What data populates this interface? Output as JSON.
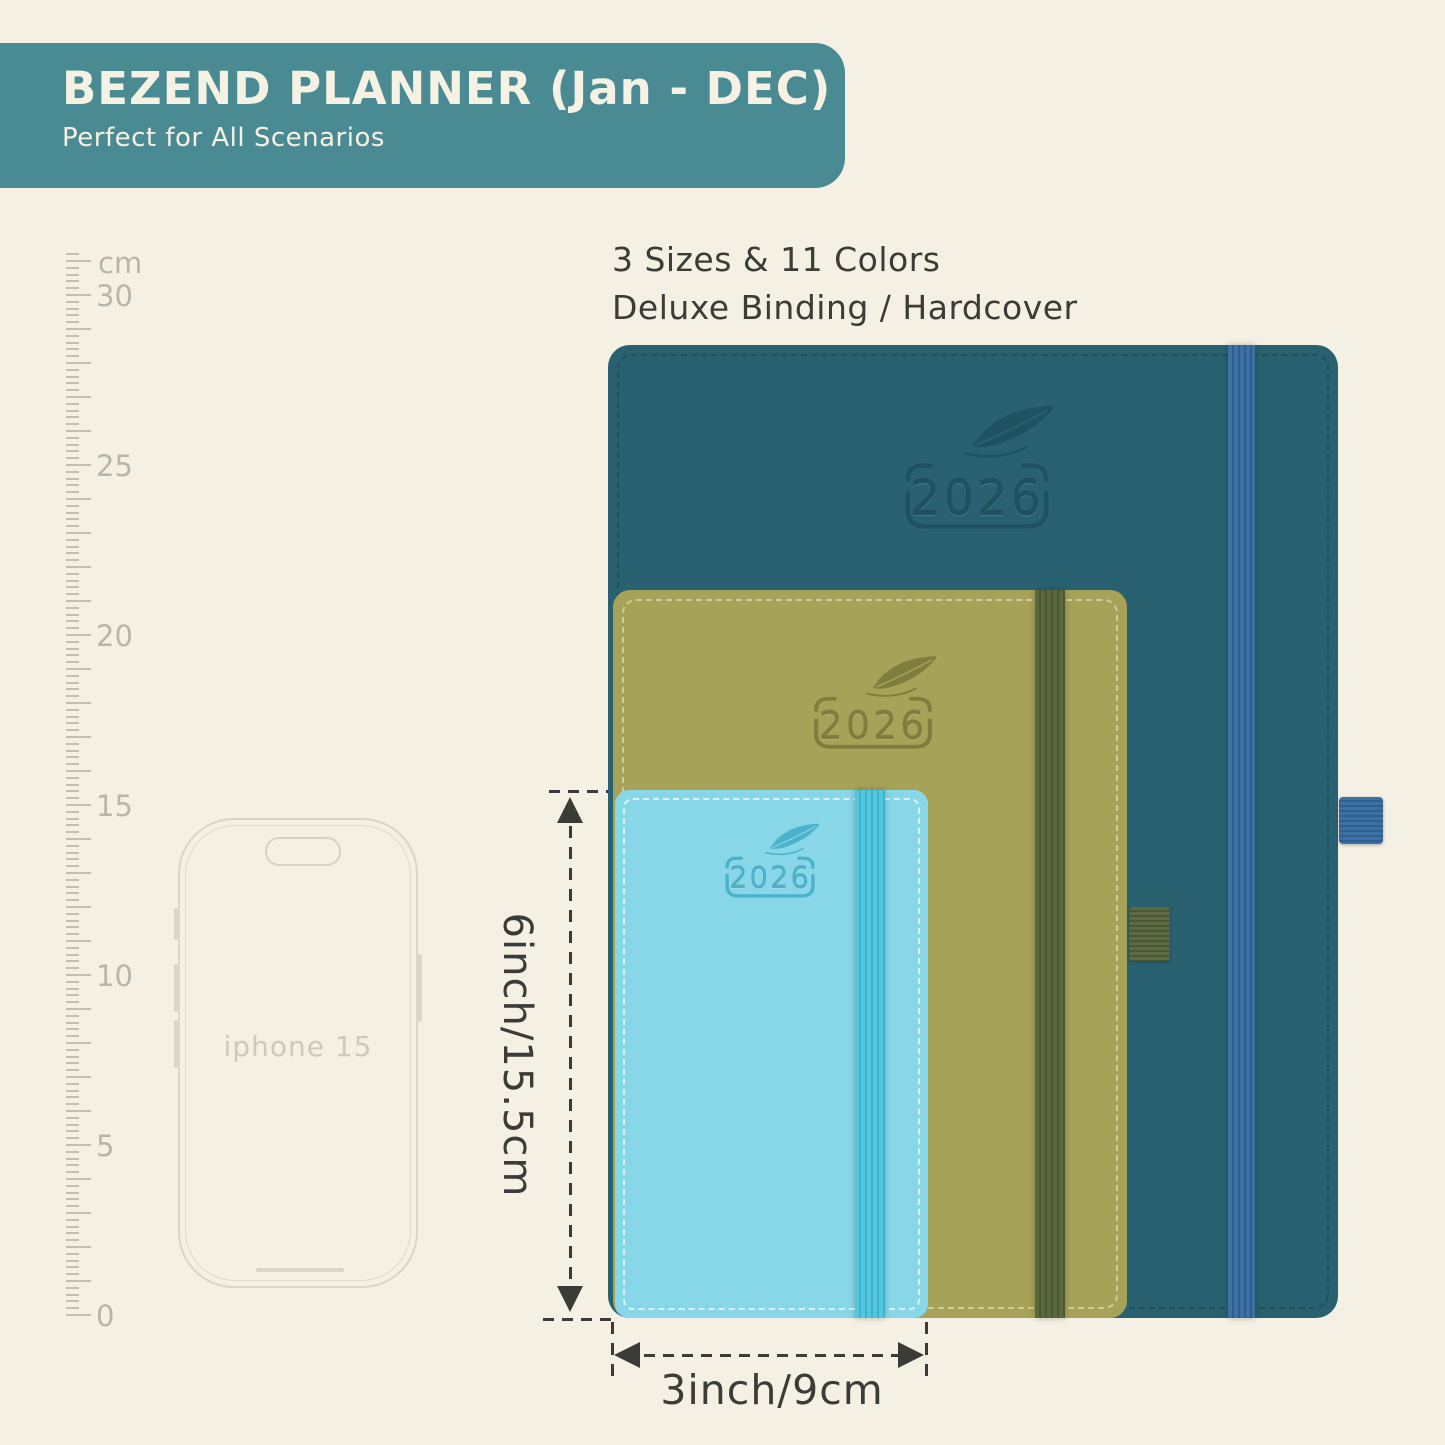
{
  "banner": {
    "title": "BEZEND PLANNER (Jan - DEC)",
    "subtitle": "Perfect for All Scenarios",
    "colors": {
      "bg": "#4a8b93",
      "text": "#f5f1e3"
    }
  },
  "headline": {
    "line1": "3 Sizes & 11 Colors",
    "line2": "Deluxe Binding / Hardcover"
  },
  "ruler": {
    "unit": "cm",
    "marks": [
      30,
      25,
      20,
      15,
      10,
      5,
      0
    ]
  },
  "phone": {
    "label": "iphone 15"
  },
  "planners": [
    {
      "size": "large",
      "year": "2026",
      "colors": {
        "cover": "#2a6170",
        "emboss": "#1e5261",
        "stitch": "#17505f",
        "band": "#3e71a3",
        "band_stripe": "#2f5d8c",
        "pen_loop": "#3e71a3",
        "pen_loop_stripe": "#305e8e"
      }
    },
    {
      "size": "medium",
      "year": "2026",
      "colors": {
        "cover": "#a6a258",
        "emboss": "#807e3e",
        "stitch": "#d8d3a4",
        "band": "#5b683e",
        "band_stripe": "#4a5730",
        "pen_loop": "#5d6b41",
        "pen_loop_stripe": "#4c5833"
      }
    },
    {
      "size": "small",
      "year": "2026",
      "colors": {
        "cover": "#87d7e8",
        "emboss": "#4bb2cc",
        "stitch": "#e6f9fc",
        "band": "#54c7df",
        "band_stripe": "#3fb3cd",
        "pen_loop": "#54c7df",
        "pen_loop_stripe": "#3fb3cd"
      }
    }
  ],
  "dimensions": {
    "height_label": "6inch/15.5cm",
    "width_label": "3inch/9cm"
  },
  "misc": {
    "background": "#f4f0e3",
    "annotation_color": "#3b3b38",
    "ruler_color": "#bdb9ac"
  }
}
